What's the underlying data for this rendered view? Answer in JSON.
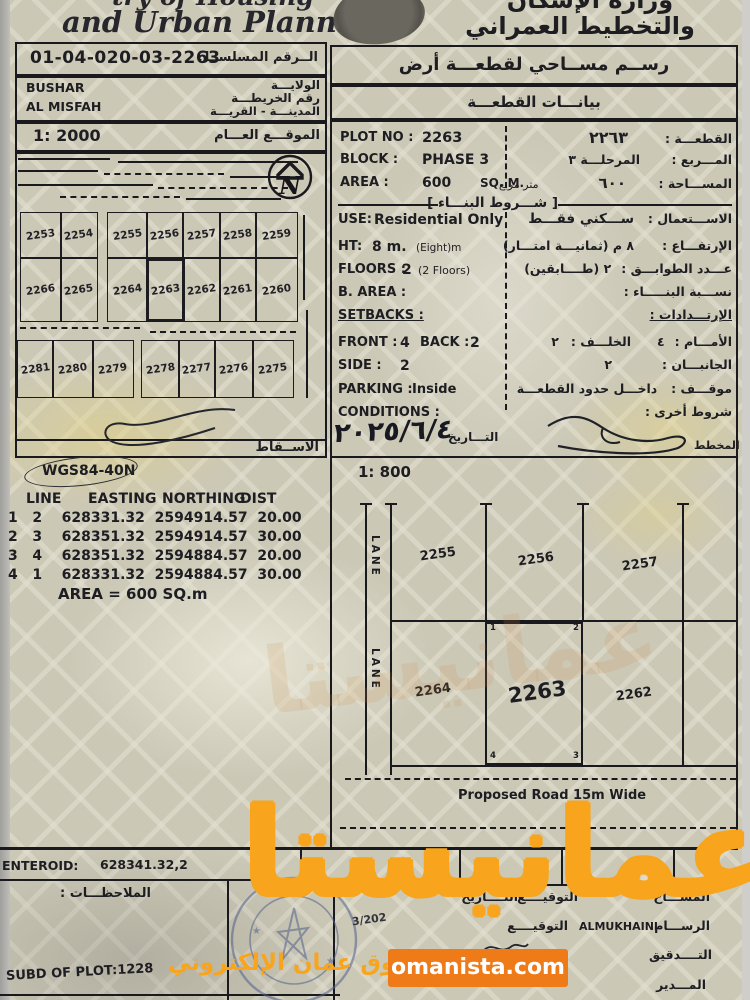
{
  "header": {
    "en_top": "try of Housing",
    "en_main": "and Urban Planning",
    "ar_line1": "وزارة الإسكان",
    "ar_line2": "والتخطيط العمراني"
  },
  "serial_box": {
    "value": "01-04-020-03-2263",
    "label_ar": "الــرقم المسلســل"
  },
  "location_box": {
    "wilaya": "BUSHAR",
    "wilaya_label": "الولايـــة",
    "map_label": "رقم الخريطـــة",
    "town": "AL MISFAH",
    "town_label": "المدينـــة - القريـــة"
  },
  "overview_map": {
    "scale": "1: 2000",
    "scale_label_ar": "الموقـــع العـــام",
    "north": "N",
    "row1": [
      "2253",
      "2254",
      "2255",
      "2256",
      "2257",
      "2258",
      "2259"
    ],
    "row2": [
      "2266",
      "2265",
      "2264",
      "2263",
      "2262",
      "2261",
      "2260"
    ],
    "row3": [
      "2281",
      "2280",
      "2279",
      "2278",
      "2277",
      "2276",
      "2275"
    ],
    "footer_label_ar": "الاســقاط"
  },
  "datum": {
    "name": "WGS84-40N"
  },
  "coords": {
    "headers": [
      "LINE",
      "EASTING",
      "NORTHING",
      "DIST"
    ],
    "rows": [
      [
        "1",
        "2",
        "628331.32",
        "2594914.57",
        "20.00"
      ],
      [
        "2",
        "3",
        "628351.32",
        "2594914.57",
        "30.00"
      ],
      [
        "3",
        "4",
        "628351.32",
        "2594884.57",
        "20.00"
      ],
      [
        "4",
        "1",
        "628331.32",
        "2594884.57",
        "30.00"
      ]
    ],
    "area_line": "AREA = 600  SQ.m"
  },
  "right_panel": {
    "title_ar": "رســم مســاحي لقطعـــة أرض",
    "subtitle_ar": "بيانـــات القطعـــة"
  },
  "plot": {
    "no_label": "PLOT NO :",
    "no": "2263",
    "no_ar": "٢٢٦٣",
    "no_ar_label": "القطعـــة :",
    "block_label": "BLOCK :",
    "block": "PHASE 3",
    "block_ar": "المرحلـــة ٣",
    "block_ar_label": "المـــربع :",
    "area_label": "AREA :",
    "area": "600",
    "area_unit": "SQ. M.",
    "area_ar": "٦٠٠",
    "area_ar_unit": "متر مربع",
    "area_ar_label": "المســـاحة :"
  },
  "rules": {
    "header_ar": "[ شـــروط البنـــاء ]",
    "use_label": "USE:",
    "use": "Residential Only",
    "use_ar": "ســـكني فقـــط",
    "use_ar_label": "الاســـتعمال :",
    "ht_label": "HT:",
    "ht": "8 m.",
    "ht_note": "(Eight)m",
    "ht_ar": "٨ م (ثمانيـــة امتـــار)",
    "ht_ar_label": "الإرتفـــاع :",
    "floors_label": "FLOORS :",
    "floors": "2",
    "floors_note": "(2 Floors)",
    "floors_ar": "٢ (طــــابقين)",
    "floors_ar_label": "عـــدد الطوابـــق :",
    "barea_label": "B. AREA :",
    "barea_ar_label": "نســـبة البنـــــاء :",
    "setbacks_label": "SETBACKS :",
    "setbacks_ar_label": "الإرتـــدادات :",
    "front_label": "FRONT :",
    "front": "4",
    "back_label": "BACK :",
    "back": "2",
    "front_ar_label": "الأمـــام :",
    "front_ar": "٤",
    "back_ar_label": "الخلـــف :",
    "back_ar": "٢",
    "side_label": "SIDE :",
    "side": "2",
    "side_ar_label": "الجانبـــان :",
    "side_ar": "٢",
    "parking_label": "PARKING :",
    "parking": "Inside",
    "parking_ar_label": "موقـــف :",
    "parking_ar": "داخـــل حدود القطعـــة",
    "cond_label": "CONDITIONS :",
    "cond_ar_label": "شروط أخرى :"
  },
  "approval": {
    "date": "٢٠٢٥/٦/٤",
    "date_label_ar": "التـــاريخ",
    "planner_label_ar": "المخطط"
  },
  "detail_map": {
    "scale": "1: 800",
    "lane": "LANE",
    "top_plots": [
      "2255",
      "2256",
      "2257"
    ],
    "bottom_plots": [
      "2264",
      "2263",
      "2262"
    ],
    "corner1": "1",
    "corner2": "2",
    "corner3": "3",
    "corner4": "4",
    "road_label": "Proposed Road 15m Wide"
  },
  "footer": {
    "centroid_label": "ENTEROID:",
    "centroid_value": "628341.32,2",
    "notes_label_ar": "الملاحظـــات :",
    "subd": "SUBD OF PLOT:1228",
    "surveyor_ar": "المســـاح",
    "draftsman_ar": "الرســـام",
    "audit_ar": "التــــدقيق",
    "manager_ar": "المـــدير",
    "sign_ar": "التوقيــــع",
    "date_ar": "التــــاريخ",
    "draftsman_name": "ALMUKHAINI",
    "date_fragment": "3/202"
  },
  "watermark": {
    "brand_ar": "عمانيستا",
    "tagline_ar": "سوق عمان الإلكتروني",
    "site": "omanista.com",
    "orange": "#f8a41c",
    "button_bg": "#ee7a18"
  }
}
